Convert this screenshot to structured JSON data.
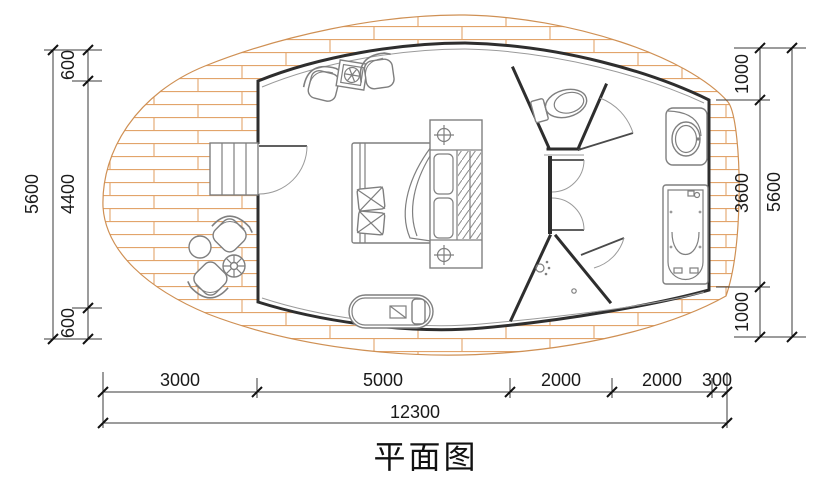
{
  "title": "平面图",
  "colors": {
    "background": "#ffffff",
    "deck_hatch": "#e2a46b",
    "wall": "#2e2e2e",
    "furniture": "#7f7f7f",
    "dimension_text": "#1a1a1a"
  },
  "dimensions": {
    "left_outer_total": "5600",
    "left_chain": [
      "600",
      "4400",
      "600"
    ],
    "right_chain": [
      "1000",
      "3600",
      "1000"
    ],
    "right_outer_total": "5600",
    "bottom_chain": [
      "3000",
      "5000",
      "2000",
      "2000",
      "300"
    ],
    "bottom_total": "12300"
  },
  "fixtures": {
    "deck": "wood-plank-deck",
    "entry_steps": "entry-steps",
    "entry_door": "entry-door",
    "lounge_area": "two-armchairs-with-plant-table",
    "bed": "double-bed-with-pillows",
    "headboard_unit": "nightstands-with-lamps-and-wardrobe",
    "bench": "chaise-bench",
    "toilet_room": "toilet-room",
    "shower_room": "shower-room",
    "sink": "vanity-sink",
    "bathtub": "bathtub",
    "deck_table": "round-deck-table",
    "parasol_table": "parasol-table",
    "deck_chairs": "two-deck-chairs"
  }
}
